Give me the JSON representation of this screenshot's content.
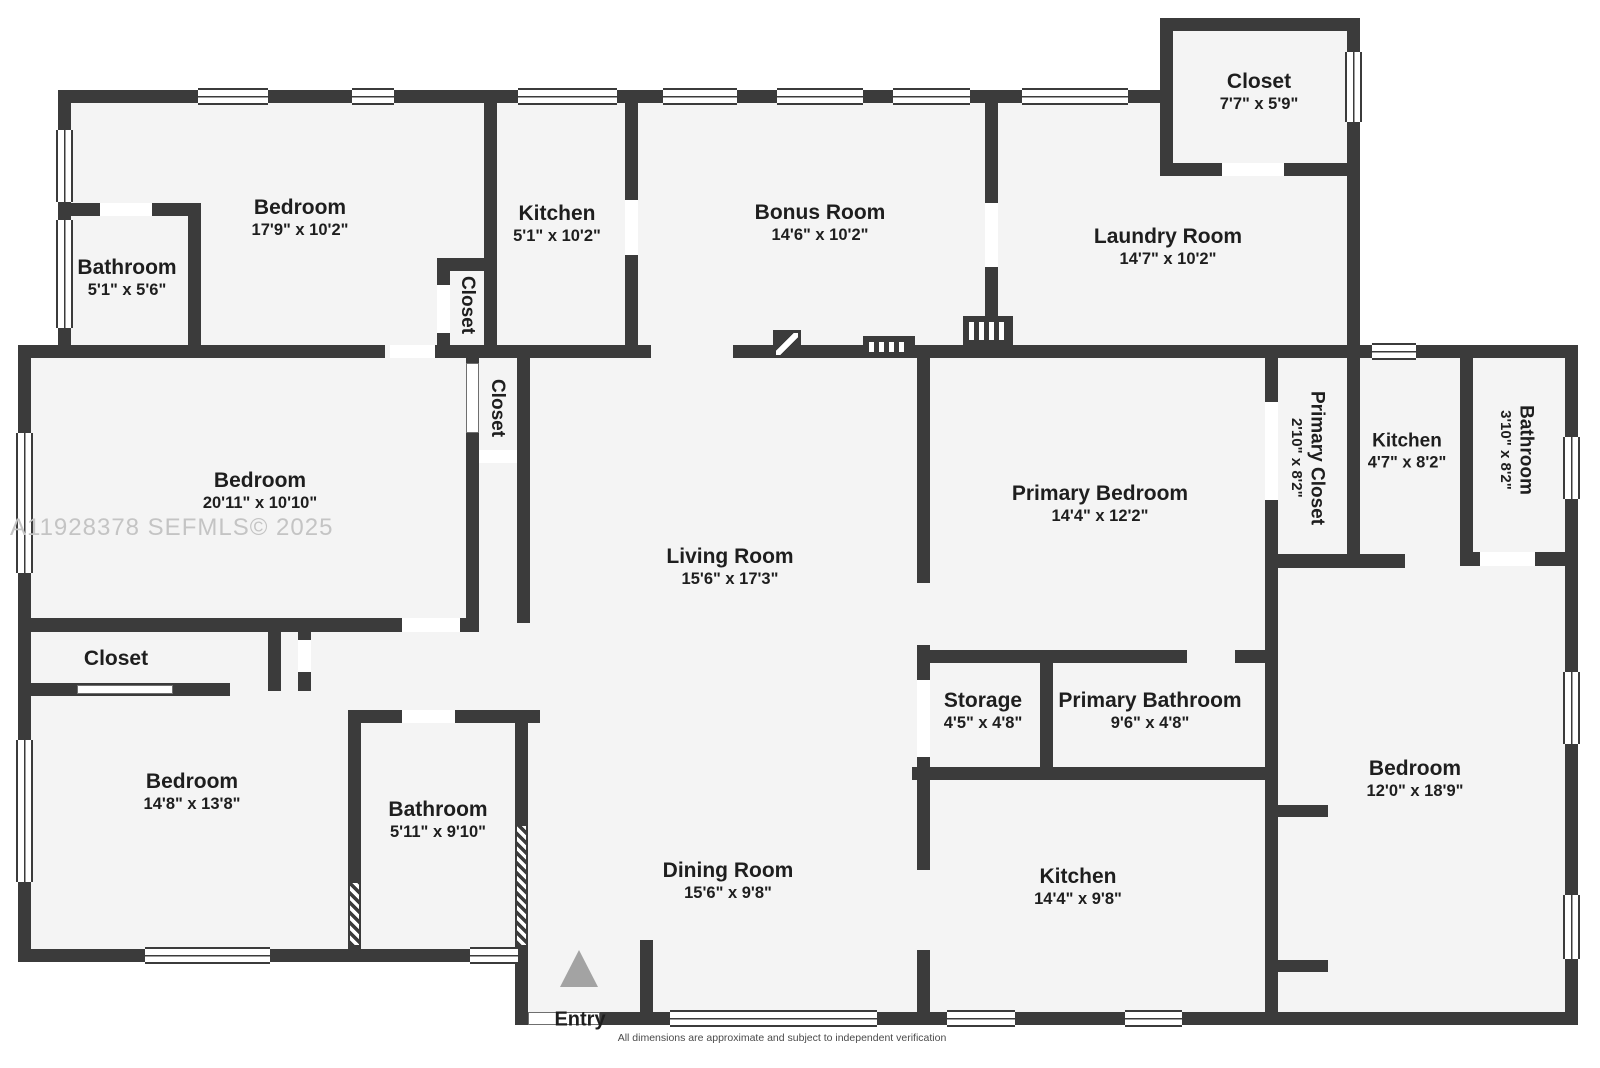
{
  "watermark": "A11928378  SEFMLS© 2025",
  "disclaimer": "All dimensions are approximate and subject to independent verification",
  "entry": {
    "label": "Entry"
  },
  "colors": {
    "wall": "#3b3b3b",
    "floor": "#f4f4f4",
    "watermark": "#c4c4c4",
    "arrow": "#a3a3a3"
  },
  "rooms": [
    {
      "id": "closet-top",
      "name": "Closet",
      "dims": "7'7\" x 5'9\""
    },
    {
      "id": "bedroom-1",
      "name": "Bedroom",
      "dims": "17'9\" x 10'2\""
    },
    {
      "id": "bathroom-1",
      "name": "Bathroom",
      "dims": "5'1\" x 5'6\""
    },
    {
      "id": "kitchen-1",
      "name": "Kitchen",
      "dims": "5'1\" x 10'2\""
    },
    {
      "id": "closet-kitchen",
      "name": "Closet",
      "dims": ""
    },
    {
      "id": "bonus-room",
      "name": "Bonus Room",
      "dims": "14'6\" x 10'2\""
    },
    {
      "id": "laundry-room",
      "name": "Laundry Room",
      "dims": "14'7\" x 10'2\""
    },
    {
      "id": "bedroom-2",
      "name": "Bedroom",
      "dims": "20'11\" x 10'10\""
    },
    {
      "id": "closet-mid",
      "name": "Closet",
      "dims": ""
    },
    {
      "id": "living-room",
      "name": "Living Room",
      "dims": "15'6\" x 17'3\""
    },
    {
      "id": "primary-bedroom",
      "name": "Primary Bedroom",
      "dims": "14'4\" x 12'2\""
    },
    {
      "id": "primary-closet",
      "name": "Primary Closet",
      "dims": "2'10\" x 8'2\""
    },
    {
      "id": "kitchen-2",
      "name": "Kitchen",
      "dims": "4'7\" x 8'2\""
    },
    {
      "id": "bathroom-2",
      "name": "Bathroom",
      "dims": "3'10\" x 8'2\""
    },
    {
      "id": "closet-lower",
      "name": "Closet",
      "dims": ""
    },
    {
      "id": "bedroom-3",
      "name": "Bedroom",
      "dims": "14'8\" x 13'8\""
    },
    {
      "id": "bathroom-3",
      "name": "Bathroom",
      "dims": "5'11\" x 9'10\""
    },
    {
      "id": "dining-room",
      "name": "Dining Room",
      "dims": "15'6\" x 9'8\""
    },
    {
      "id": "storage",
      "name": "Storage",
      "dims": "4'5\" x 4'8\""
    },
    {
      "id": "primary-bathroom",
      "name": "Primary Bathroom",
      "dims": "9'6\" x 4'8\""
    },
    {
      "id": "kitchen-3",
      "name": "Kitchen",
      "dims": "14'4\" x 9'8\""
    },
    {
      "id": "bedroom-4",
      "name": "Bedroom",
      "dims": "12'0\" x 18'9\""
    }
  ]
}
